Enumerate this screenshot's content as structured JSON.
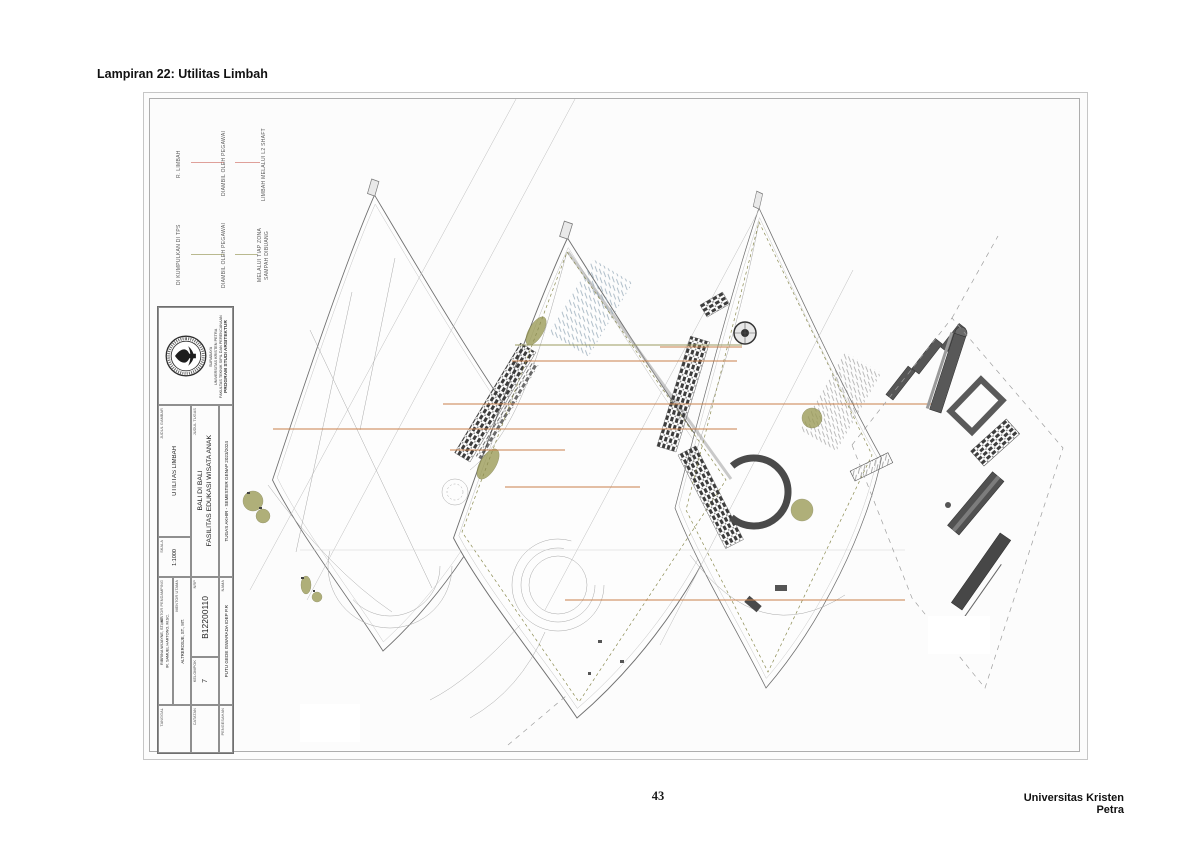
{
  "page": {
    "heading": "Lampiran 22: Utilitas Limbah",
    "page_number": "43",
    "footer_right": "Universitas Kristen Petra"
  },
  "annotations": {
    "flow_limbah": {
      "line_color": "#dfa09a",
      "steps": [
        "R. LIMBAH",
        "DIAMBIL OLEH PEGAWAI",
        "LIMBAH MELALUI L2 SHAFT"
      ]
    },
    "flow_sampah": {
      "line_color": "#b9b98f",
      "steps": [
        "DI KUMPULKAN DI TPS",
        "DIAMBIL OLEH PEGAWAI",
        "SAMPAH DIBUANG MELALUI TIAP ZONA"
      ],
      "step3_lines": [
        "SAMPAH DIBUANG",
        "MELALUI TIAP ZONA"
      ]
    }
  },
  "title_block": {
    "institution_lines": [
      "PROGRAM STUDI ARSITEKTUR",
      "FAKULTAS TEKNIK SIPIL DAN PERENCANAAN",
      "UNIVERSITAS KRISTEN PETRA",
      "SURABAYA"
    ],
    "course": "TUGAS AKHIR - SEMESTER GENAP 2023/2024",
    "judul_tugas_label": "JUDUL TUGAS",
    "judul_tugas_lines": [
      "FASILITAS EDUKASI WISATA ANAK",
      "BALI DI BALI"
    ],
    "judul_gambar_label": "JUDUL GAMBAR",
    "judul_gambar": "UTILITAS LIMBAH",
    "skala_label": "SKALA",
    "skala": "1:1000",
    "nama_label": "NAMA",
    "nama": "PUTU GEDE ISWARADA IDEP P.R",
    "nrp_label": "NRP",
    "nrp": "B12200110",
    "kelompok_label": "KELOMPOK",
    "kelompok": "7",
    "mentor_utama_label": "MENTOR UTAMA",
    "mentor_utama": "ALTREROSJE, ST., MT.",
    "mentor_pendamping_label": "MENTOR PENDAMPING",
    "mentor_pendamping_lines": [
      "IR. SAMUEL HARTONO, M.SC.",
      "RIBRINA WIJAYNE, ST., MT."
    ],
    "tanggal_label": "TANGGAL",
    "catatan_label": "CATATAN",
    "pengesahan_label": "PENGESAHAN"
  },
  "drawing": {
    "colors": {
      "connector_orange": "#c9804a",
      "flow_limbah_pink": "#dfa09a",
      "flow_sampah_olive": "#b9b98f",
      "waste_room_highlight": "#9a9a55",
      "building_dark": "#3d3d3d",
      "parking_hatch_blue": "#93a7b6",
      "outline_gray": "#707070"
    }
  }
}
